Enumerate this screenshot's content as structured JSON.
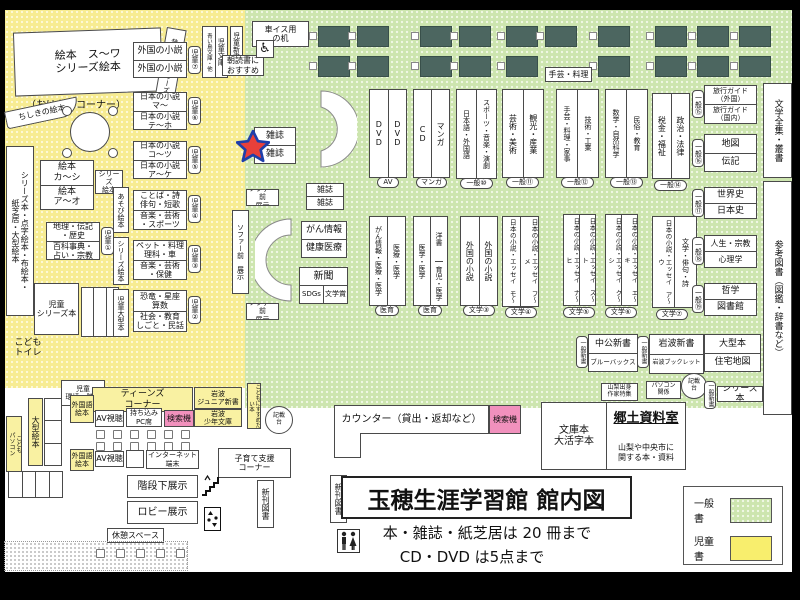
{
  "title": {
    "main": "玉穂生涯学習館 館内図",
    "rule1": "本・雑誌・紙芝居は 20 冊まで",
    "rule2": "CD・DVD は5点まで"
  },
  "legend": {
    "general": "一般書",
    "children": "児童書"
  },
  "kids": {
    "ehon_series": "絵本　ス～ワ\nシリーズ絵本",
    "ohanashi": "（おはなしコーナー）",
    "mukashi": "昔ばなしシリーズ絵本",
    "chishiki": "ちしきの絵本",
    "gaikoku1": "外国の小説",
    "gaikoku2": "外国の小説",
    "b7": "児童⑦",
    "jp_ma": "日本の小説\nマ～",
    "jp_teho": "日本の小説\nテ～ホ",
    "b6": "児童⑥",
    "jp_kotsu": "日本の小説\nコ～ツ",
    "jp_ake": "日本の小説\nア～ケ",
    "b5": "児童⑤",
    "kotoba": "ことば・詩\n俳句・短歌",
    "ongaku_sport": "音楽・芸術\n・スポーツ",
    "b4": "児童④",
    "pet": "ペット・料理\n理科・車",
    "ongaku_hoken": "音楽・芸術\n・保健",
    "b3": "児童③",
    "kyoryu": "恐竜・星座\n算数",
    "shakai": "社会・教育\nしごと・民話",
    "b2": "児童②",
    "chiri": "地理・伝記\n・歴史",
    "hyakka": "百科事典・\n占い・宗教",
    "b1": "児童①",
    "ehon_ka": "絵本\nカ～シ",
    "ehon_a": "絵本\nア～オ",
    "series_tag": "シリーズ\n絵本",
    "tall": "シリーズ本・点字絵本・布絵本・\n紙芝居・大型絵本",
    "jido_series": "児童\nシリーズ本",
    "asobi": "あそび絵本",
    "series_v": "シリーズ絵本",
    "jido_ogata": "児童大型本",
    "toilet": "こども\nトイレ",
    "kankyo": "児童\n環境・防災",
    "ogata_ehon": "大型絵本",
    "kodomo_pc": "こども\nパソコン",
    "teens": "ティーンズ\nコーナー",
    "gaikokugo1": "外国語\n絵本",
    "gaikokugo2": "外国語\n絵本",
    "av1": "AV視聴",
    "av2": "AV視聴",
    "pc_seki": "持ち込み\nPC席",
    "kensaku": "検索機",
    "iwanami_jr": "岩波\nジュニア新書",
    "iwanami_sho": "岩波\n少年文庫",
    "susume": "こどもにすすめたい本",
    "internet": "インターネット\n端末",
    "kosodate": "子育て支援\nコーナー",
    "kaidan": "階段下展示",
    "lobby": "ロビー展示",
    "kyukei": "休憩スペース",
    "jido_bunko": "児童文庫",
    "aoitori": "青い鳥文庫・他",
    "jido_shinsho": "児童新書",
    "asadoku": "朝読書に\nおすすめ",
    "kurumaisu": "車イス用\nの机"
  },
  "general": {
    "zasshi": "雑誌",
    "gan_info": "がん情報",
    "kenko": "健康医療",
    "shinbun": "新聞",
    "sdgs": "SDGs",
    "bungakusho": "文学賞",
    "sofa": "ソファー前\n展示",
    "sofa_v": "ソファー前　展示",
    "dvd": "DVD",
    "cd": "CD",
    "manga": "マンガ",
    "av_badge": "AV",
    "manga_badge": "マンガ",
    "nihongo": "日本語・外国語",
    "sports": "スポーツ・音楽・演劇",
    "g10": "一般⑩",
    "geijutsu": "芸術・美術",
    "kanko": "観光・産業",
    "g11": "一般⑪",
    "shugei": "手芸・料理・家事",
    "gijutsu": "技術・工業",
    "g12": "一般⑫",
    "shugei_label": "手芸・料理",
    "sugaku": "数学・自然科学",
    "minzoku": "民俗・教育",
    "g13": "一般⑬",
    "zeikin": "税金・福祉",
    "seiji": "政治・法律",
    "g14": "一般⑭",
    "gan_iryo": "がん情報・医療・医学",
    "iryo": "医療・医学",
    "iiku": "医育",
    "igaku": "医学・医学",
    "yosho": "洋書",
    "ikuji": "育児・医学",
    "gaikoku": "外国の小説",
    "bun3": "文学③",
    "jp_mo": "日本の小説・エッセイ　モ～",
    "jp_fume": "日本の小説・エッセイ　フ～メ",
    "bun4": "文学④",
    "jp_nahi": "日本の小説・エッセイ　ナ～ヒ",
    "jp_suto": "日本の小説・エッセイ　ス～ト",
    "bun5": "文学⑤",
    "jp_kushi": "日本の小説・エッセイ　ク～シ",
    "jp_eki": "日本の小説・エッセイ　エ～キ",
    "bun6": "文学⑥",
    "jp_au": "日本の小説・エッセイ　ア～ウ",
    "bungaku_haiku": "文学・俳句・詩",
    "bun7": "文学⑦",
    "ryoko_gai": "旅行ガイド\n（外国）",
    "ryoko_koku": "旅行ガイド\n（国内）",
    "g15": "一般⑮",
    "chizu": "地図",
    "denki": "伝記",
    "g16": "一般⑯",
    "sekaishi": "世界史",
    "nihonshi": "日本史",
    "g17": "一般⑰",
    "jinsei": "人生・宗教",
    "shinri": "心理学",
    "g18": "一般⑱",
    "tetsugaku": "哲学",
    "toshokan": "図書館",
    "g19": "一般⑲",
    "zenshu": "文学全集・叢書",
    "sanko": "参考図書（図鑑・辞書など）",
    "chuko": "中公新書",
    "blue_backs": "ブルーバックス",
    "shinsho": "一般新書",
    "iwanami": "岩波新書",
    "booklet": "岩波ブックレット",
    "ogata": "大型本",
    "jutaku": "住宅地図",
    "yamanashi": "山梨出身\n作家特集",
    "pc_kankei": "パソコン\n関係",
    "kisaidai": "記載\n台",
    "series_hon": "シリーズ本"
  },
  "bottom": {
    "counter": "カウンター（貸出・返却など）",
    "kensaku": "検索機",
    "shinkan": "新刊図書",
    "bunko": "文庫本\n大活字本",
    "kyodo": "郷土資料室",
    "kyodo_desc": "山梨や中央市に\n関する本・資料"
  }
}
